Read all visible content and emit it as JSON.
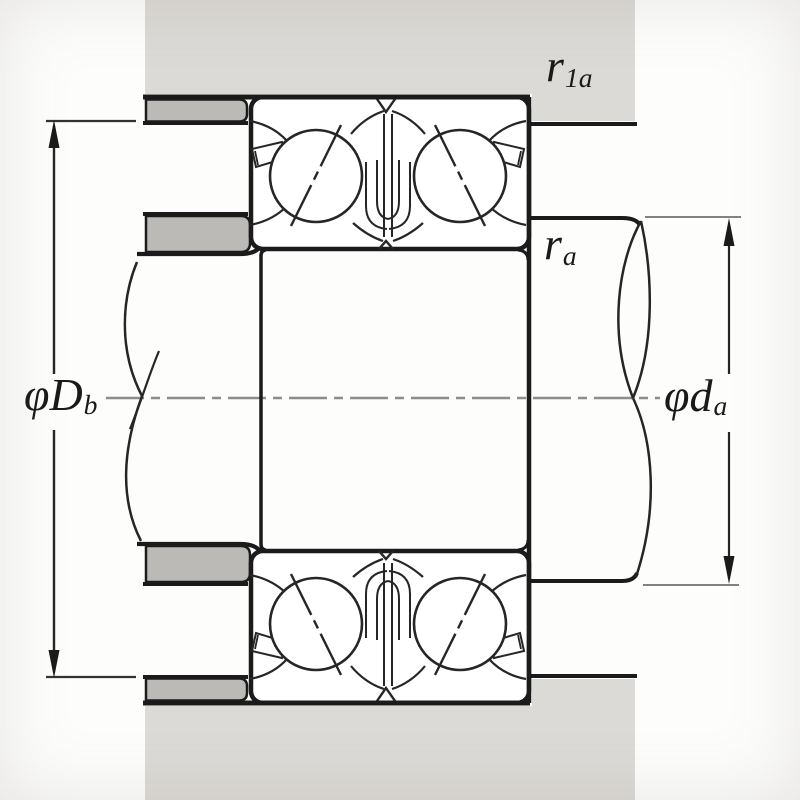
{
  "figure": {
    "title": "duplex-angular-contact-bearing-mounting-cross-section",
    "labels": {
      "housing_fillet": {
        "main": "r",
        "sub": "1a"
      },
      "shaft_fillet": {
        "main": "r",
        "sub": "a"
      },
      "housing_shoulder_diameter": {
        "main": "φD",
        "sub": "b"
      },
      "shaft_abutment_diameter": {
        "main": "φd",
        "sub": "a"
      }
    },
    "colors": {
      "background": "#fdfdfc",
      "housing_fill": "#dcdad6",
      "spacer_fill": "#bcbab6",
      "line": "#1b1b1b",
      "inner_line": "#262626",
      "axis": "#8c8c8c",
      "ext_line_right": "#828282",
      "ext_line_left": "#333333"
    }
  }
}
